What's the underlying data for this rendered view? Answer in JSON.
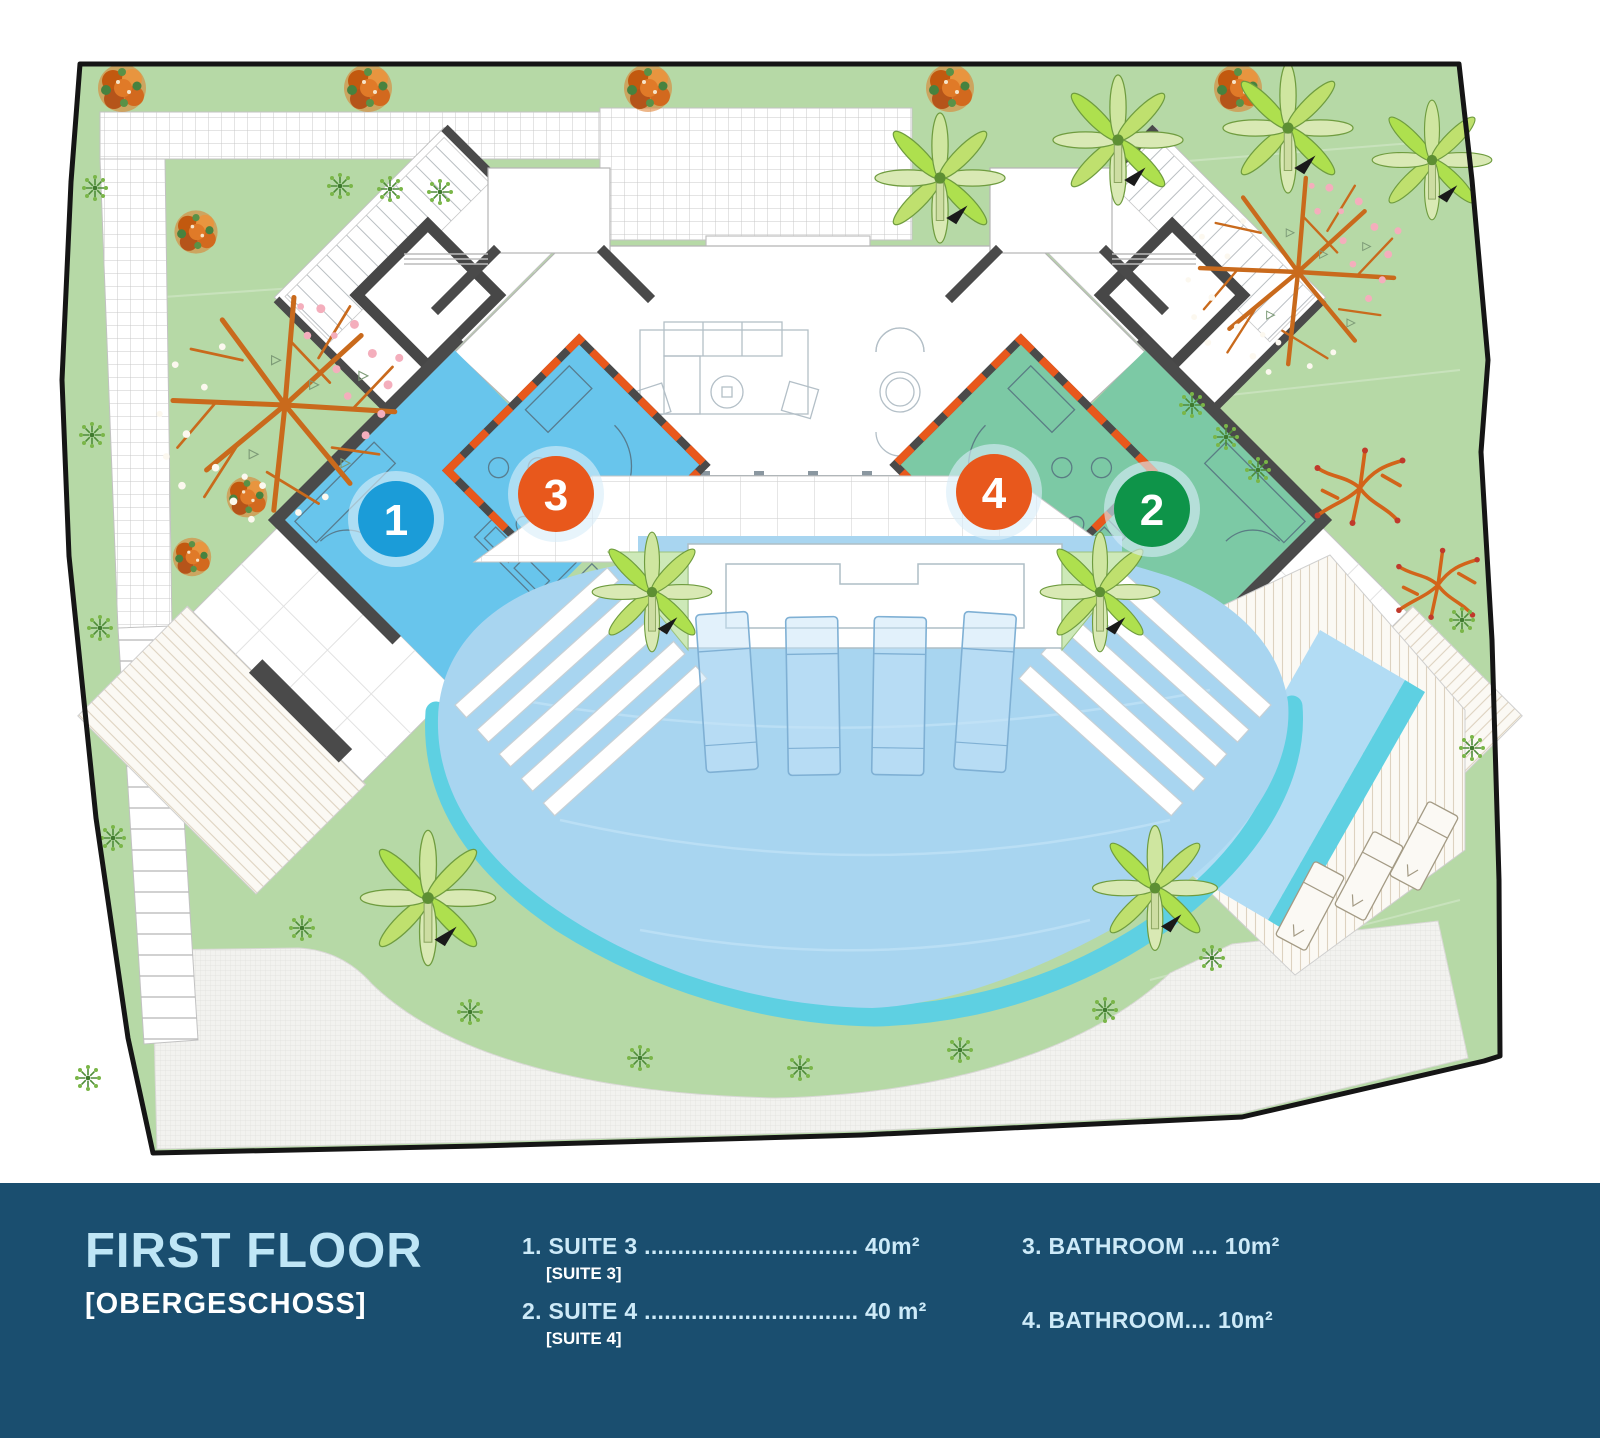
{
  "title": {
    "main": "FIRST FLOOR",
    "sub": "[OBERGESCHOSS]"
  },
  "legend": {
    "items": [
      {
        "text": "1. SUITE 3 ................................ 40m²",
        "sub": "[SUITE 3]"
      },
      {
        "text": "2. SUITE 4 ................................ 40 m²",
        "sub": "[SUITE 4]"
      },
      {
        "text": "3. BATHROOM .... 10m²",
        "sub": ""
      },
      {
        "text": "4. BATHROOM.... 10m²",
        "sub": ""
      }
    ]
  },
  "markers": [
    {
      "num": "1",
      "color": "#1b9cd8"
    },
    {
      "num": "2",
      "color": "#0e9449"
    },
    {
      "num": "3",
      "color": "#e8581c"
    },
    {
      "num": "4",
      "color": "#e8581c"
    }
  ],
  "colors": {
    "bar": "#1a4e6f",
    "title": "#bfe6f6",
    "legend_text": "#cdeaf8",
    "legend_sub": "#ffffff",
    "suite_blue": "#68c5ec",
    "suite_green": "#7cc9a5",
    "garden": "#b6d9a6",
    "pool": "#a8d5f0",
    "pool_rim": "#5ed0e2",
    "wall": "#4a4a4a",
    "marker_halo": "#d8eef8"
  }
}
